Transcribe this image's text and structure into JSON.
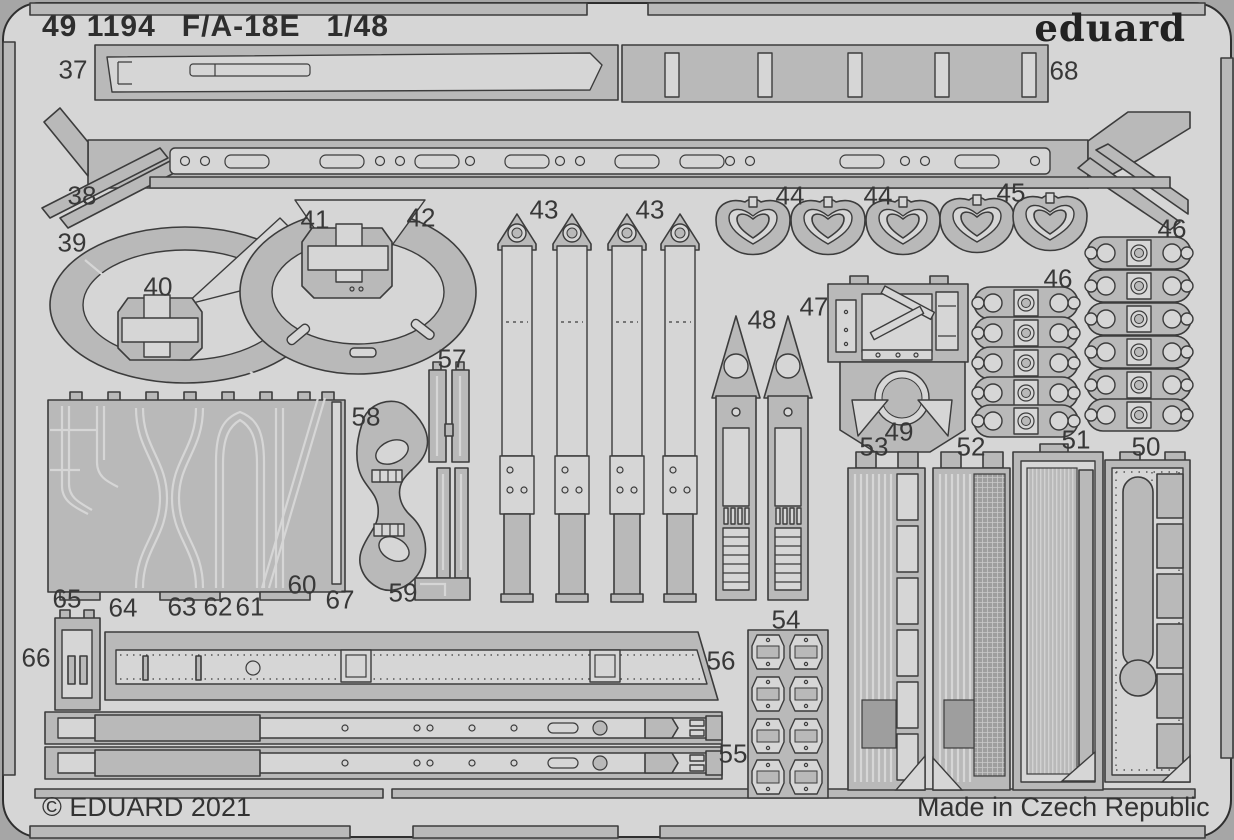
{
  "sheet": {
    "catalog_number": "49 1194",
    "aircraft": "F/A-18E",
    "scale": "1/48",
    "brand": "eduard",
    "copyright": "© EDUARD 2021",
    "made_in": "Made in Czech Republic"
  },
  "colors": {
    "background": "#a6a6a6",
    "sheet": "#d6d6d6",
    "part": "#b9b9b9",
    "part_dark": "#9e9e9e",
    "outline": "#3c3c3c",
    "text": "#2e2e2e"
  },
  "part_labels": [
    {
      "number": "37",
      "x": 73,
      "y": 70
    },
    {
      "number": "68",
      "x": 1064,
      "y": 71
    },
    {
      "number": "38",
      "x": 82,
      "y": 196
    },
    {
      "number": "39",
      "x": 72,
      "y": 243
    },
    {
      "number": "40",
      "x": 158,
      "y": 287
    },
    {
      "number": "41",
      "x": 315,
      "y": 220
    },
    {
      "number": "42",
      "x": 421,
      "y": 218
    },
    {
      "number": "43",
      "x": 544,
      "y": 210
    },
    {
      "number": "43",
      "x": 650,
      "y": 210
    },
    {
      "number": "44",
      "x": 790,
      "y": 196
    },
    {
      "number": "44",
      "x": 878,
      "y": 196
    },
    {
      "number": "45",
      "x": 1011,
      "y": 193
    },
    {
      "number": "46",
      "x": 1172,
      "y": 229
    },
    {
      "number": "46",
      "x": 1058,
      "y": 279
    },
    {
      "number": "47",
      "x": 814,
      "y": 307
    },
    {
      "number": "48",
      "x": 762,
      "y": 320
    },
    {
      "number": "49",
      "x": 899,
      "y": 432
    },
    {
      "number": "50",
      "x": 1146,
      "y": 447
    },
    {
      "number": "51",
      "x": 1076,
      "y": 440
    },
    {
      "number": "52",
      "x": 971,
      "y": 447
    },
    {
      "number": "53",
      "x": 874,
      "y": 447
    },
    {
      "number": "54",
      "x": 786,
      "y": 620
    },
    {
      "number": "55",
      "x": 733,
      "y": 754
    },
    {
      "number": "56",
      "x": 721,
      "y": 661
    },
    {
      "number": "57",
      "x": 452,
      "y": 359
    },
    {
      "number": "58",
      "x": 366,
      "y": 417
    },
    {
      "number": "59",
      "x": 403,
      "y": 593
    },
    {
      "number": "60",
      "x": 302,
      "y": 585
    },
    {
      "number": "61",
      "x": 250,
      "y": 607
    },
    {
      "number": "62",
      "x": 218,
      "y": 607
    },
    {
      "number": "63",
      "x": 182,
      "y": 607
    },
    {
      "number": "64",
      "x": 123,
      "y": 608
    },
    {
      "number": "65",
      "x": 67,
      "y": 599
    },
    {
      "number": "66",
      "x": 36,
      "y": 658
    },
    {
      "number": "67",
      "x": 340,
      "y": 600
    }
  ]
}
